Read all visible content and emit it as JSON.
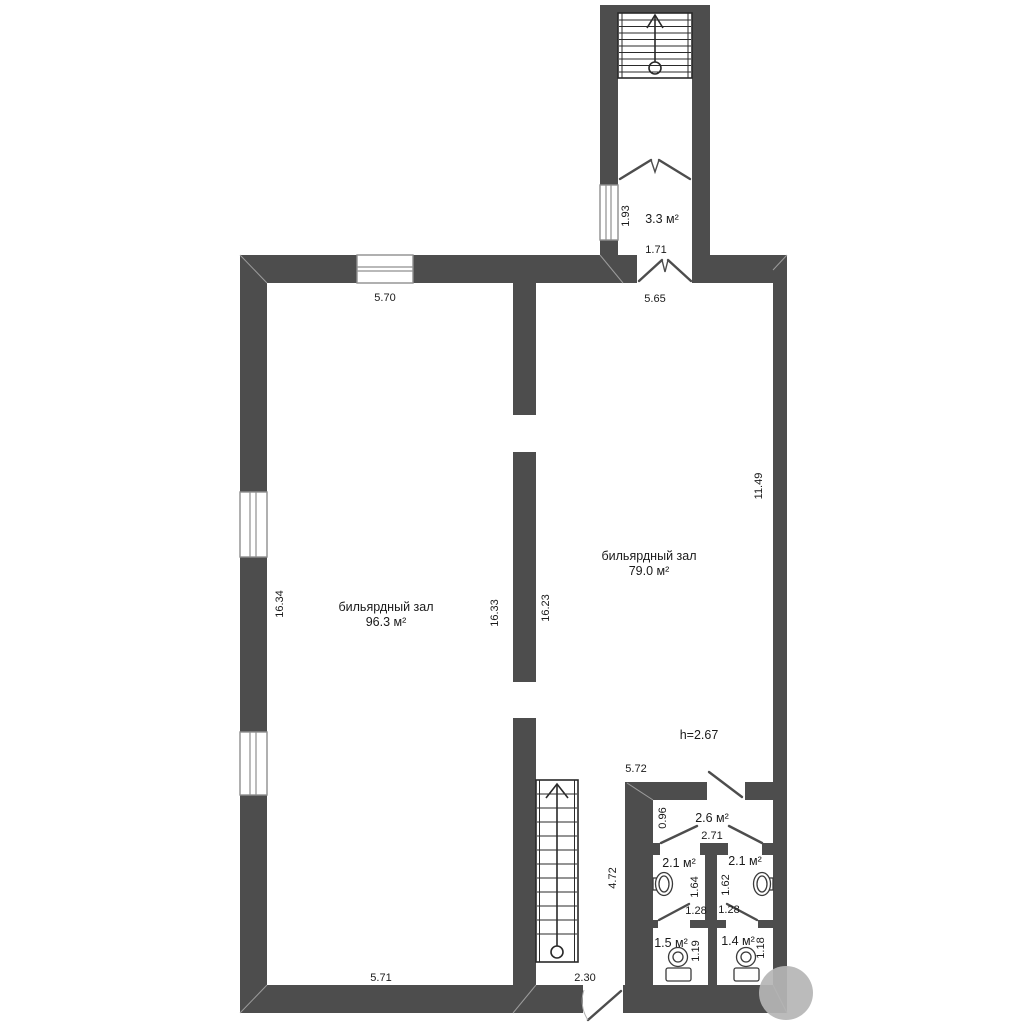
{
  "plan": {
    "rooms": {
      "hall_left": {
        "name": "бильярдный зал",
        "area": "96.3 м²"
      },
      "hall_right": {
        "name": "бильярдный зал",
        "area": "79.0 м²"
      },
      "vestibule": {
        "area": "3.3 м²"
      },
      "corridor": {
        "area": "2.6 м²"
      },
      "washroom_left": {
        "area": "2.1 м²"
      },
      "washroom_right": {
        "area": "2.1 м²"
      },
      "wc_left": {
        "area": "1.5 м²"
      },
      "wc_right": {
        "area": "1.4 м²"
      }
    },
    "ceiling_height": "h=2.67",
    "dimensions": {
      "top_window": "5.70",
      "hall_right_top": "5.65",
      "vestibule_width": "1.71",
      "vestibule_depth": "1.93",
      "hall_left_height": "16.34",
      "mid_wall_left": "16.33",
      "mid_wall_right": "16.23",
      "hall_right_height": "11.49",
      "hall_right_bottom": "5.72",
      "corridor_depth": "0.96",
      "corridor_width": "2.71",
      "stair_zone_height": "4.72",
      "washroom_left_depth": "1.64",
      "washroom_right_depth": "1.62",
      "washroom_left_width": "1.28",
      "washroom_right_width": "1.28",
      "wc_left_depth": "1.19",
      "wc_right_depth": "1.18",
      "hall_left_bottom": "5.71",
      "stair_zone_width": "2.30"
    },
    "colors": {
      "wall": "#4d4d4d",
      "watermark": "#b5b5b5"
    }
  }
}
